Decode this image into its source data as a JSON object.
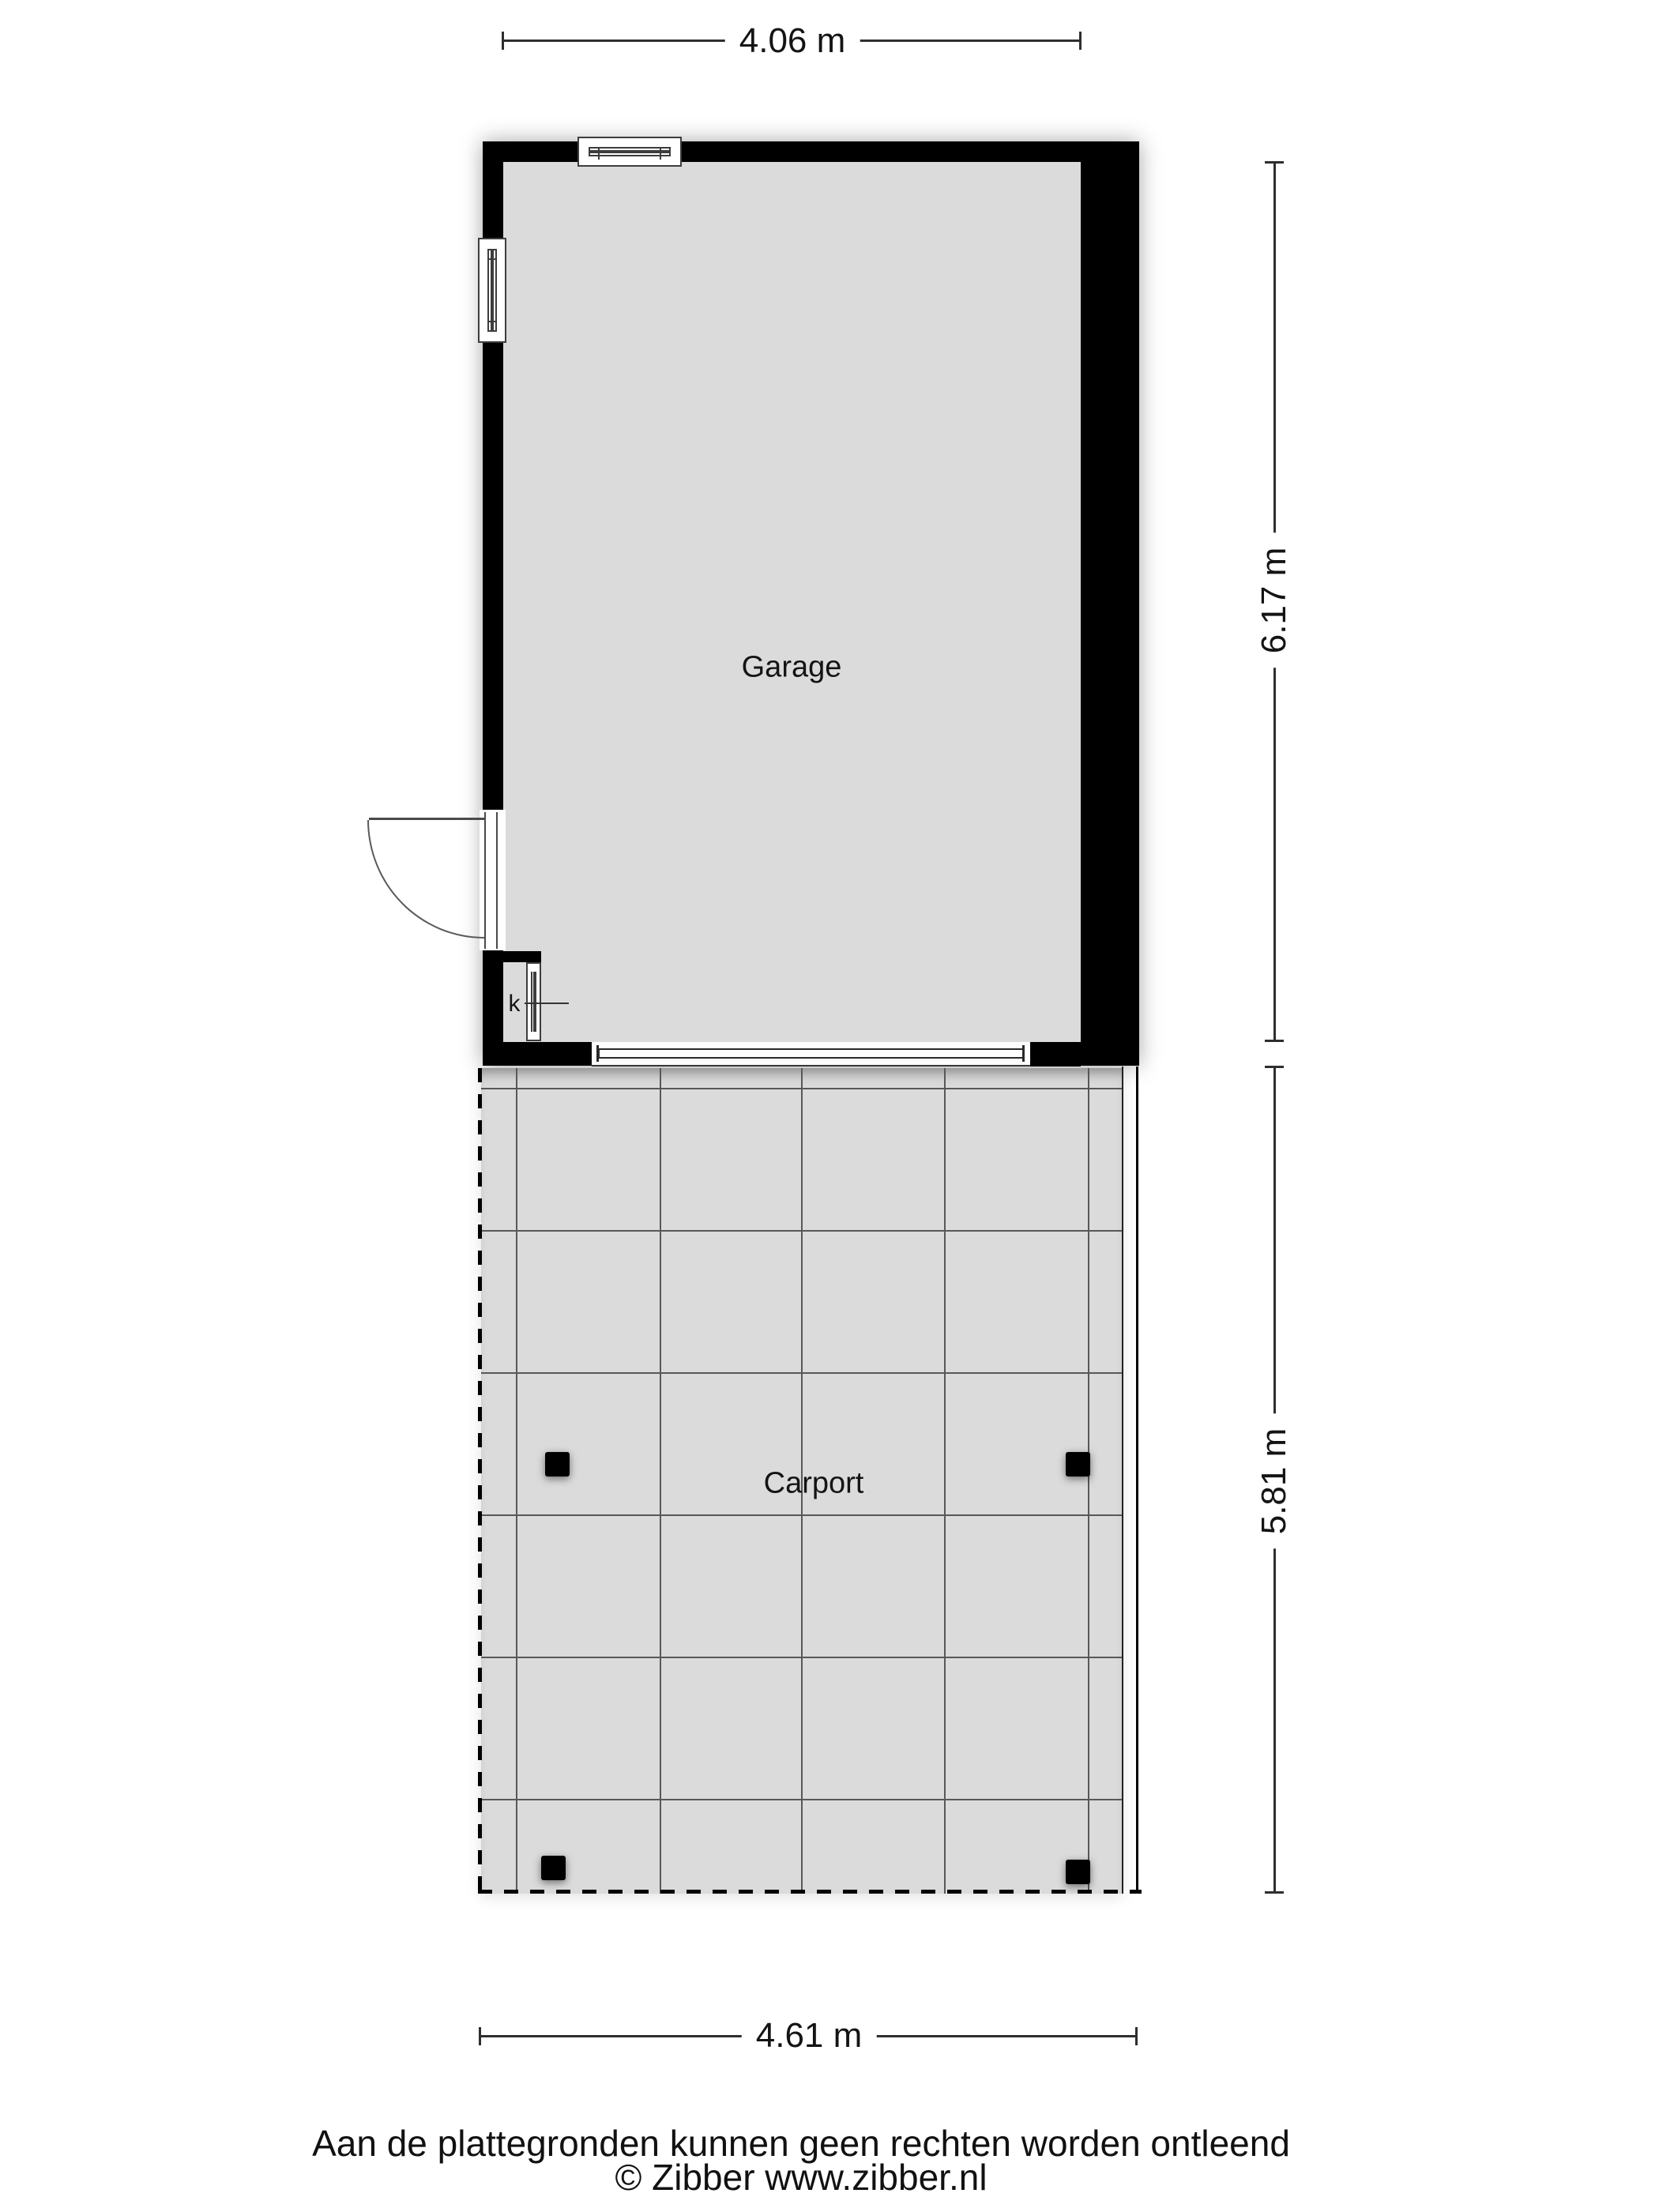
{
  "plan": {
    "rooms": [
      {
        "name": "Garage"
      },
      {
        "name": "Carport"
      }
    ],
    "closet": {
      "label": "k"
    },
    "dimensions": {
      "garage_width": "4.06 m",
      "garage_depth": "6.17 m",
      "carport_depth": "5.81 m",
      "carport_width": "4.61 m"
    },
    "footer": {
      "disclaimer": "Aan de plattegronden kunnen geen rechten worden ontleend",
      "copyright": "© Zibber www.zibber.nl"
    },
    "colors": {
      "wall": "#000000",
      "floor": "#dbdbdb",
      "dimension_line": "#2e2e2e",
      "grid_line": "#585858",
      "background": "#ffffff"
    }
  }
}
